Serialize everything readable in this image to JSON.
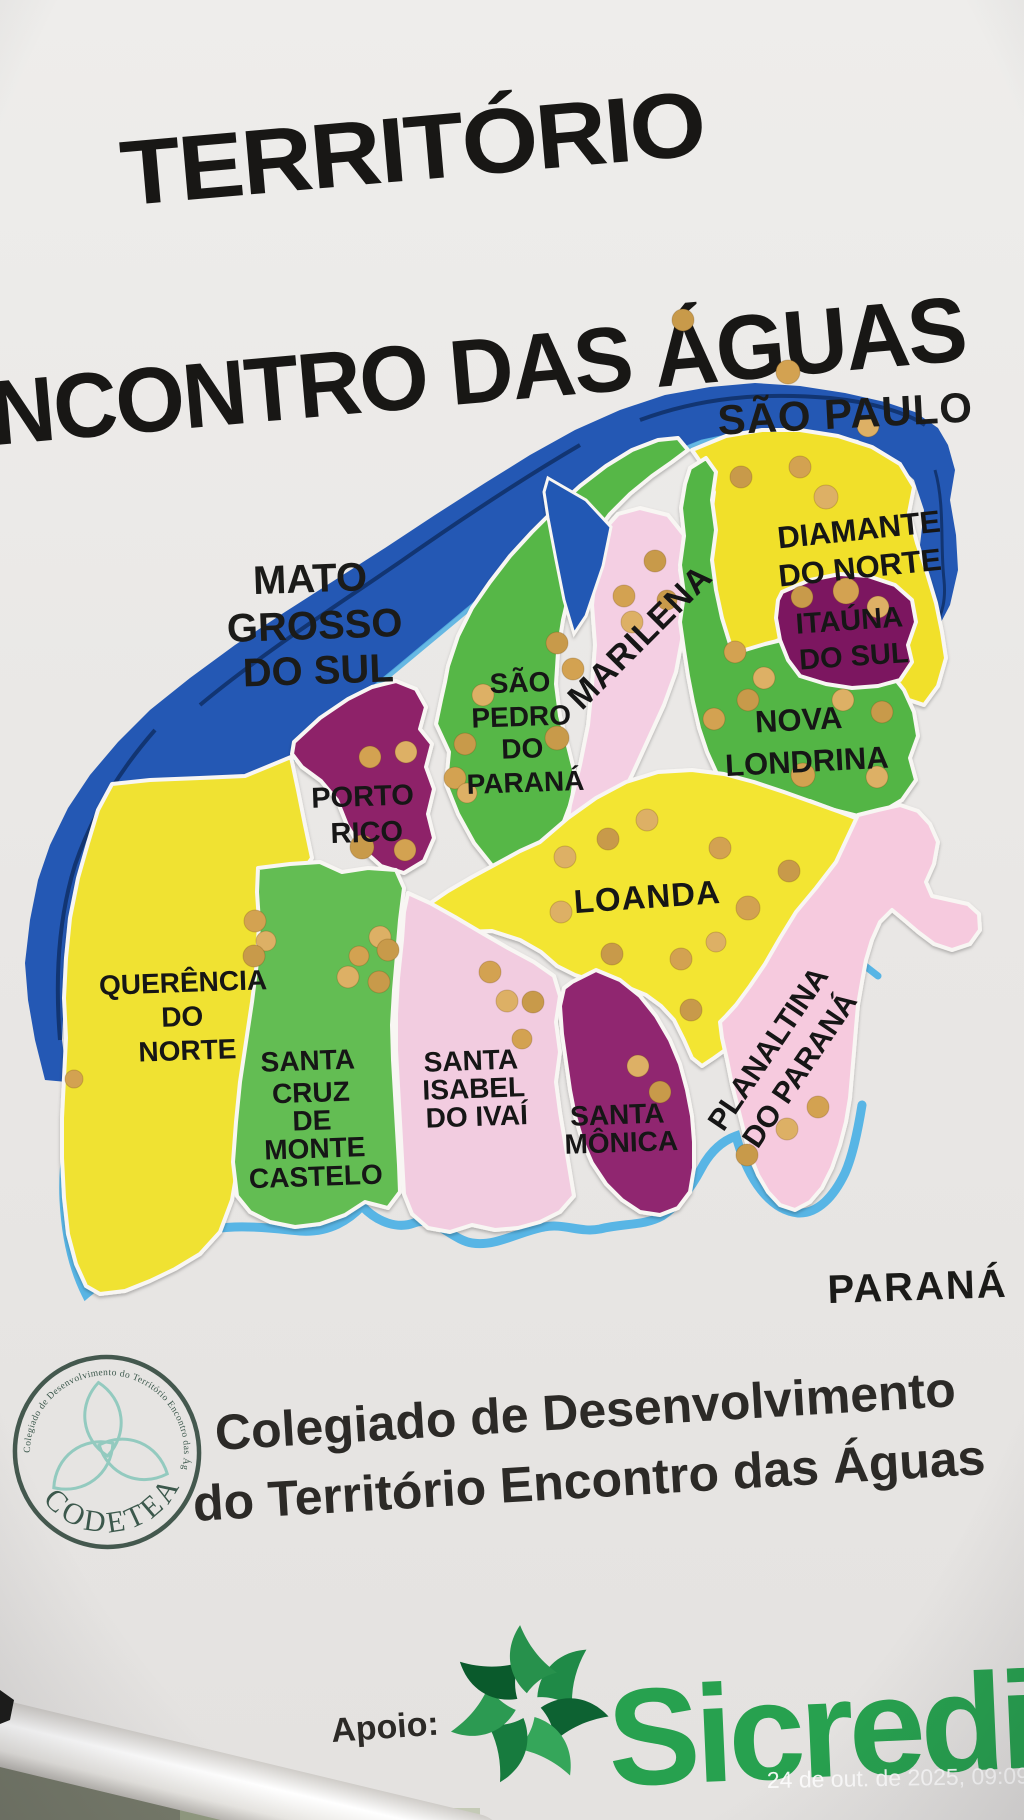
{
  "poster": {
    "title": {
      "line1": "TERRITÓRIO",
      "line2": "ENCONTRO DAS ÁGUAS"
    },
    "states": {
      "sao_paulo": "SÃO PAULO",
      "mato_grosso_do_sul": {
        "line1": "MATO",
        "line2": "GROSSO",
        "line3": "DO SUL"
      },
      "parana": "PARANÁ"
    },
    "municipalities": {
      "diamante_do_norte": {
        "name": "Diamante do Norte",
        "color": "#f1e02c",
        "lines": [
          "DIAMANTE",
          "DO NORTE"
        ]
      },
      "itauna_do_sul": {
        "name": "Itaúna do Sul",
        "color": "#7b1360",
        "lines": [
          "ITAÚNA",
          "DO SUL"
        ]
      },
      "nova_londrina": {
        "name": "Nova Londrina",
        "color": "#52b545",
        "lines": [
          "NOVA",
          "LONDRINA"
        ]
      },
      "marilena": {
        "name": "Marilena",
        "color": "#f4cfe3",
        "lines": [
          "MARILENA"
        ]
      },
      "sao_pedro_do_parana": {
        "name": "São Pedro do Paraná",
        "color": "#57b747",
        "lines": [
          "SÃO",
          "PEDRO",
          "DO",
          "PARANÁ"
        ]
      },
      "porto_rico": {
        "name": "Porto Rico",
        "color": "#8e2069",
        "lines": [
          "PORTO",
          "RICO"
        ]
      },
      "loanda": {
        "name": "Loanda",
        "color": "#f3e532",
        "lines": [
          "LOANDA"
        ]
      },
      "querencia_do_norte": {
        "name": "Querência do Norte",
        "color": "#f0e232",
        "lines": [
          "QUERÊNCIA",
          "DO",
          "NORTE"
        ]
      },
      "santa_cruz_de_monte_castelo": {
        "name": "Santa Cruz de Monte Castelo",
        "color": "#63bd52",
        "lines": [
          "SANTA",
          "CRUZ",
          "DE",
          "MONTE",
          "CASTELO"
        ]
      },
      "santa_isabel_do_ivai": {
        "name": "Santa Isabel do Ivaí",
        "color": "#f2cce0",
        "lines": [
          "SANTA",
          "ISABEL",
          "DO IVAÍ"
        ]
      },
      "santa_monica": {
        "name": "Santa Mônica",
        "color": "#90266f",
        "lines": [
          "SANTA",
          "MÔNICA"
        ]
      },
      "planaltina_do_parana": {
        "name": "Planaltina do Paraná",
        "color": "#f6cade",
        "lines": [
          "PLANALTINA",
          "DO PARANÁ"
        ]
      }
    },
    "rivers": {
      "parana_river_color": "#2458b4",
      "ivai_river_color": "#58b5e5"
    },
    "pins": {
      "color": "#d3a251",
      "count": 61,
      "positions": [
        [
          683,
          320
        ],
        [
          788,
          372,
          12
        ],
        [
          868,
          426
        ],
        [
          741,
          477
        ],
        [
          800,
          467
        ],
        [
          826,
          497,
          12
        ],
        [
          802,
          597
        ],
        [
          846,
          591,
          13
        ],
        [
          878,
          607
        ],
        [
          655,
          561
        ],
        [
          624,
          596
        ],
        [
          632,
          622
        ],
        [
          667,
          600,
          10
        ],
        [
          735,
          652
        ],
        [
          764,
          678
        ],
        [
          748,
          700
        ],
        [
          714,
          719
        ],
        [
          843,
          700
        ],
        [
          882,
          712
        ],
        [
          803,
          775,
          12
        ],
        [
          877,
          777
        ],
        [
          557,
          643
        ],
        [
          573,
          669
        ],
        [
          483,
          695
        ],
        [
          465,
          744
        ],
        [
          455,
          778
        ],
        [
          467,
          793,
          10
        ],
        [
          557,
          738,
          12
        ],
        [
          370,
          757
        ],
        [
          406,
          752
        ],
        [
          362,
          847,
          12
        ],
        [
          405,
          850
        ],
        [
          647,
          820
        ],
        [
          608,
          839
        ],
        [
          720,
          848
        ],
        [
          565,
          857
        ],
        [
          789,
          871
        ],
        [
          748,
          908,
          12
        ],
        [
          561,
          912
        ],
        [
          612,
          954
        ],
        [
          681,
          959
        ],
        [
          716,
          942,
          10
        ],
        [
          691,
          1010
        ],
        [
          255,
          921
        ],
        [
          266,
          941,
          10
        ],
        [
          254,
          956
        ],
        [
          74,
          1079,
          9
        ],
        [
          380,
          937
        ],
        [
          388,
          950
        ],
        [
          359,
          956,
          10
        ],
        [
          348,
          977
        ],
        [
          379,
          982
        ],
        [
          490,
          972
        ],
        [
          507,
          1001
        ],
        [
          533,
          1002
        ],
        [
          522,
          1039,
          10
        ],
        [
          638,
          1066
        ],
        [
          660,
          1092
        ],
        [
          818,
          1107
        ],
        [
          787,
          1129
        ],
        [
          747,
          1155,
          11
        ]
      ]
    },
    "footer": {
      "logo": {
        "ring_text": "Colegiado de Desenvolvimento do Território  Encontro das Águas",
        "acronym": "CODETEA"
      },
      "caption_line1": "Colegiado de Desenvolvimento",
      "caption_line2": "do Território Encontro das Águas",
      "support_label": "Apoio:",
      "sponsor": "Sicredi",
      "sponsor_color": "#27a14f"
    },
    "watermark": "24 de out. de 2025, 09:09"
  }
}
